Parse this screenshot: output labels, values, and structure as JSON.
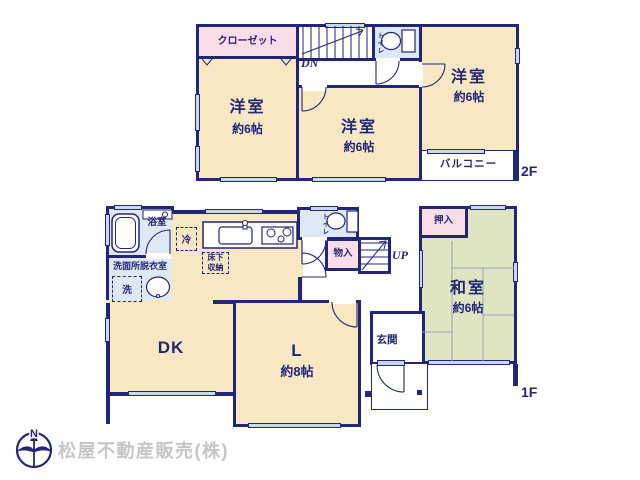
{
  "colors": {
    "wall": "#232578",
    "room_cream": "#f7e7c3",
    "closet_pink": "#fadde6",
    "wet_area_blue": "#dde9f6",
    "tatami_green": "#dfe5c1",
    "window_fill": "#c9d7ef",
    "watermark_gray": "#c5c5c5"
  },
  "floor2f": {
    "floor_label": "2F",
    "closet_label": "クローゼット",
    "room_left": {
      "name": "洋室",
      "size": "約6帖"
    },
    "room_mid": {
      "name": "洋室",
      "size": "約6帖"
    },
    "room_right": {
      "name": "洋室",
      "size": "約6帖"
    },
    "toilet_label": "トイレ",
    "stairs_label": "DN",
    "balcony_label": "バルコニー"
  },
  "floor1f": {
    "floor_label": "1F",
    "bath_label": "浴室",
    "washroom_label": "洗面所脱衣室",
    "washer_label": "洗",
    "fridge_label": "冷",
    "underfloor_label_1": "床下",
    "underfloor_label_2": "収納",
    "toilet_label": "トイレ",
    "storage_label": "物入",
    "stairs_label": "UP",
    "oshiire_label": "押入",
    "washitsu": {
      "name": "和室",
      "size": "約6帖"
    },
    "genkan_label": "玄関",
    "dk_label": "DK",
    "living": {
      "name": "L",
      "size": "約8帖"
    }
  },
  "footer": {
    "compass_n": "N",
    "company_name": "松屋不動産販売(株)"
  }
}
